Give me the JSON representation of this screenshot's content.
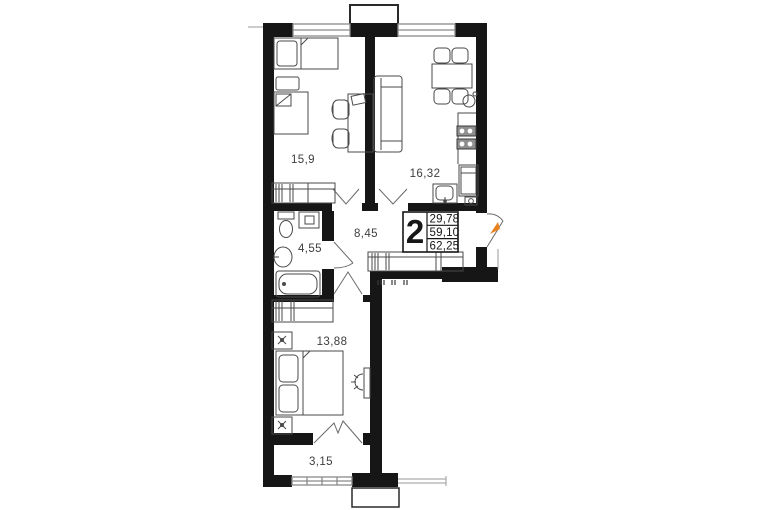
{
  "plan": {
    "badge": {
      "rooms_count": "2",
      "areas": [
        "29,78",
        "59,10",
        "62,25"
      ]
    },
    "rooms": {
      "bedroom_top": "15,9",
      "kitchen_living": "16,32",
      "hallway": "8,45",
      "bathroom": "4,55",
      "bedroom_bottom": "13,88",
      "balcony": "3,15"
    },
    "colors": {
      "wall": "#161616",
      "furniture_stroke": "#4a4a4a",
      "entrance_marker": "#e8821e",
      "background": "#ffffff"
    }
  }
}
